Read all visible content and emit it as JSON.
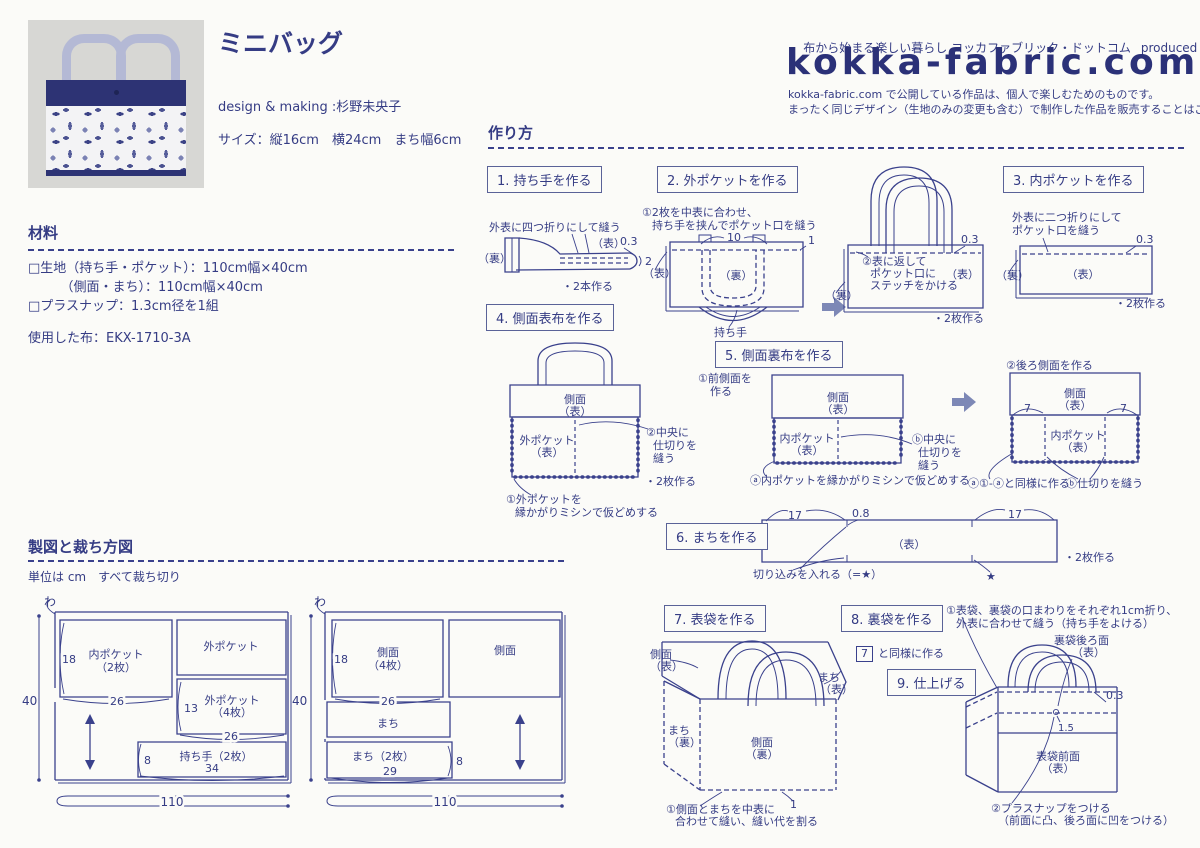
{
  "colors": {
    "ink": "#353c84",
    "line": "#3a418c",
    "navy": "#2d3374",
    "arrow": "#7d88b6",
    "paper": "#fbfbf8"
  },
  "header": {
    "title": "ミニバッグ",
    "credit": "design & making :杉野未央子",
    "size": "サイズ：縦16cm　横24cm　まち幅6cm",
    "tagline": "布から始まる楽しい暮らし コッカファブリック・ドットコム",
    "produced_by": "produced by",
    "brand": "KOKKA",
    "logo": "kokka-fabric.com",
    "notice1": "kokka-fabric.com で公開している作品は、個人で楽しむためのものです。",
    "notice2": "まったく同じデザイン（生地のみの変更も含む）で制作した作品を販売することはご遠慮ください。"
  },
  "materials": {
    "heading": "材料",
    "item1": "□生地（持ち手・ポケット）：110cm幅×40cm",
    "item2": "　　　（側面・まち）：110cm幅×40cm",
    "item3": "□プラスナップ：1.3cm径を1組",
    "used": "使用した布：EKX-1710-3A"
  },
  "howto": {
    "heading": "作り方",
    "steps": [
      {
        "title": "1. 持ち手を作る",
        "labels": {
          "caption": "外表に四つ折りにして縫う",
          "ura": "（裏）",
          "omote": "（表）",
          "v03": "0.3",
          "v2": "2",
          "make": "・2本作る"
        }
      },
      {
        "title": "2. 外ポケットを作る",
        "labels": {
          "note1a": "①2枚を中表に合わせ、",
          "note1b": "持ち手を挟んでポケット口を縫う",
          "v10": "10",
          "v1": "1",
          "omote": "（表）",
          "ura": "（裏）",
          "handle": "持ち手",
          "note2a": "②表に返して",
          "note2b": "ポケット口に",
          "note2c": "ステッチをかける",
          "v03": "0.3",
          "omote2": "（表）",
          "ura2": "（裏）",
          "make": "・2枚作る"
        }
      },
      {
        "title": "3. 内ポケットを作る",
        "labels": {
          "note1a": "外表に二つ折りにして",
          "note1b": "ポケット口を縫う",
          "v03": "0.3",
          "ura": "（裏）",
          "omote": "（表）",
          "make": "・2枚作る"
        }
      },
      {
        "title": "4. 側面表布を作る",
        "labels": {
          "side": "側面",
          "side2": "（表）",
          "pocket": "外ポケット",
          "pocket2": "（表）",
          "note2a": "②中央に",
          "note2b": "仕切りを",
          "note2c": "縫う",
          "make": "・2枚作る",
          "note1a": "①外ポケットを",
          "note1b": "縁かがりミシンで仮どめする"
        }
      },
      {
        "title": "5. 側面裏布を作る",
        "labels": {
          "note1a": "①前側面を",
          "note1b": "作る",
          "side": "側面",
          "side2": "（表）",
          "pocket": "内ポケット",
          "pocket2": "（表）",
          "noteBa": "ⓑ中央に",
          "noteBb": "仕切りを",
          "noteBc": "縫う",
          "noteA": "ⓐ内ポケットを縁かがりミシンで仮どめする",
          "note2": "②後ろ側面を作る",
          "sideR": "側面",
          "sideR2": "（表）",
          "pocketR": "内ポケット",
          "pocketR2": "（表）",
          "v7a": "7",
          "v7b": "7",
          "noteA2": "ⓐ①-ⓐと同様に作る",
          "noteB2": "ⓑ仕切りを縫う"
        }
      },
      {
        "title": "6. まちを作る",
        "labels": {
          "v17a": "17",
          "v08": "0.8",
          "v17b": "17",
          "omote": "（表）",
          "cut": "切り込みを入れる（=★）",
          "star": "★",
          "make": "・2枚作る"
        }
      },
      {
        "title": "7. 表袋を作る",
        "labels": {
          "sideO": "側面",
          "sideO2": "（表）",
          "machiO": "まち",
          "machiO2": "（表）",
          "machiU": "まち",
          "machiU2": "（裏）",
          "sideU": "側面",
          "sideU2": "（裏）",
          "v1": "1",
          "note1a": "①側面とまちを中表に",
          "note1b": "合わせて縫い、縫い代を割る"
        }
      },
      {
        "title": "8. 裏袋を作る",
        "labels": {
          "ref": "7",
          "note": "と同様に作る"
        }
      },
      {
        "title": "9. 仕上げる",
        "labels": {
          "note1a": "①表袋、裏袋の口まわりをそれぞれ1cm折り、",
          "note1b": "外表に合わせて縫う（持ち手をよける）",
          "backL": "裏袋後ろ面",
          "backL2": "（表）",
          "v03": "0.3",
          "v15": "1.5",
          "frontL": "表袋前面",
          "frontL2": "（表）",
          "note2a": "②プラスナップをつける",
          "note2b": "（前面に凸、後ろ面に凹をつける）"
        }
      }
    ]
  },
  "cutting": {
    "heading": "製図と裁ち方図",
    "note": "単位は cm　すべて裁ち切り",
    "left": {
      "fold": "わ",
      "h": "40",
      "w": "110",
      "p1": "内ポケット",
      "p1n": "（2枚）",
      "p1h": "18",
      "p1w": "26",
      "p2": "外ポケット",
      "p3": "外ポケット",
      "p3n": "（4枚）",
      "p3h": "13",
      "p3w": "26",
      "p4": "持ち手（2枚）",
      "p4h": "8",
      "p4w": "34"
    },
    "right": {
      "fold": "わ",
      "h": "40",
      "w": "110",
      "p1": "側面",
      "p1n": "（4枚）",
      "p1h": "18",
      "p1w": "26",
      "p2": "側面",
      "p3": "まち",
      "p4": "まち（2枚）",
      "p4w": "29",
      "p4h": "8"
    }
  }
}
